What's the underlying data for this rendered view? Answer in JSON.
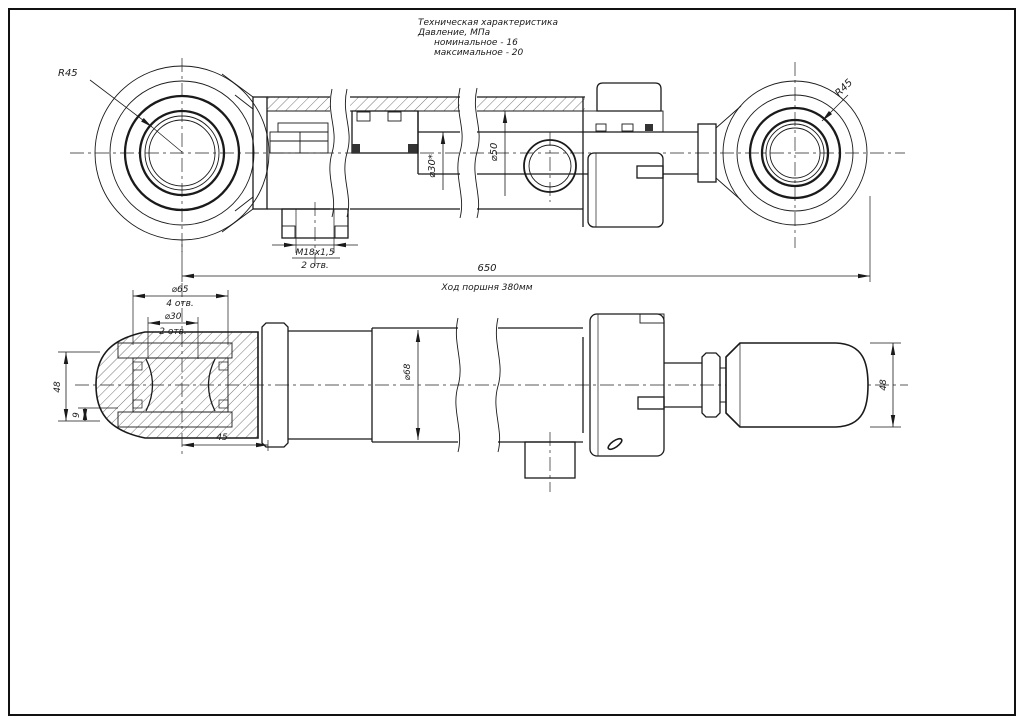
{
  "sheet": {
    "background": "#ffffff",
    "line_color": "#1a1a1a"
  },
  "tech_spec": {
    "title": "Техническая характеристика",
    "pressure_label": "Давление, МПа",
    "nominal": "номинальное - 16",
    "maximum": "максимальное - 20"
  },
  "top_view": {
    "radius_left": "R45",
    "radius_right": "R45",
    "rod_dia": "⌀30*",
    "bore_dia": "⌀50",
    "port_thread": "М18х1,5",
    "port_qty": "2 отв.",
    "overall_length": "650",
    "stroke_note": "Ход поршня 380мм"
  },
  "bottom_view": {
    "eye_bore_dia": "⌀65",
    "eye_bore_qty": "4 отв.",
    "pin_dia": "⌀30",
    "pin_qty": "2 отв.",
    "barrel_dia": "⌀68",
    "eye_width_left": "48",
    "offset": "9",
    "eye_length": "45",
    "eye_width_right": "48"
  }
}
